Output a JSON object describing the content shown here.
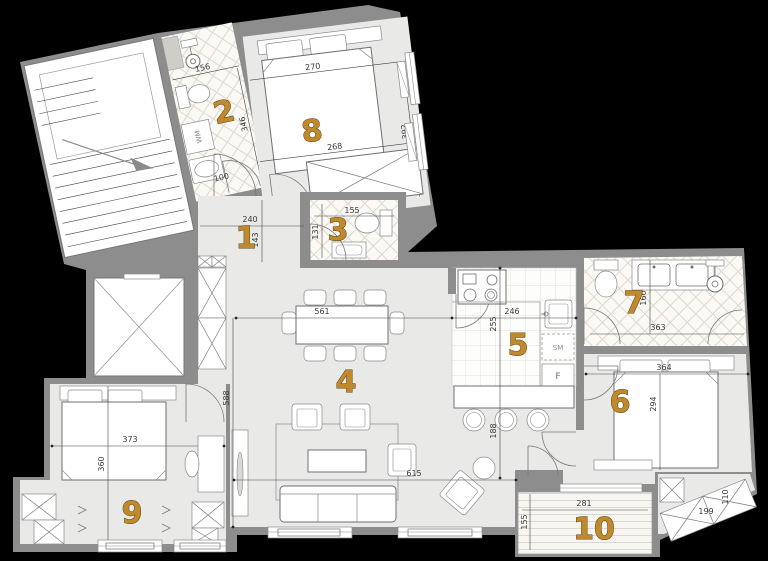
{
  "title": "apartment-floor-plan",
  "colors": {
    "background": "#000000",
    "wall": "#8d8d8d",
    "floor": "#e9e9e8",
    "wet_floor": "#faf9f6",
    "room_number_fill": "#c0892e",
    "room_number_outline": "#5c430f",
    "dimension_text": "#3a3a3a"
  },
  "rooms": [
    {
      "number": "1",
      "width": "240",
      "depth": "143"
    },
    {
      "number": "2",
      "width": "156",
      "depth": "346",
      "washer_label": "WM",
      "door_width": "100"
    },
    {
      "number": "3",
      "width": "155",
      "depth": "131"
    },
    {
      "number": "4",
      "table_wall_span": "561",
      "room_depth": "588",
      "window_wall_span": "615",
      "passage_width": "188"
    },
    {
      "number": "5",
      "width": "246",
      "depth": "255",
      "dishwasher_label": "SM",
      "fridge_label": "F"
    },
    {
      "number": "6",
      "width": "364",
      "depth": "294"
    },
    {
      "number": "7",
      "width": "363",
      "depth": "160"
    },
    {
      "number": "8",
      "bed_wall_span": "270",
      "depth": "392",
      "wardrobe_wall_span": "268"
    },
    {
      "number": "9",
      "width": "373",
      "depth": "360"
    },
    {
      "number": "10",
      "width": "281",
      "depth": "155"
    }
  ],
  "closet": {
    "width": "199",
    "depth": "110"
  }
}
